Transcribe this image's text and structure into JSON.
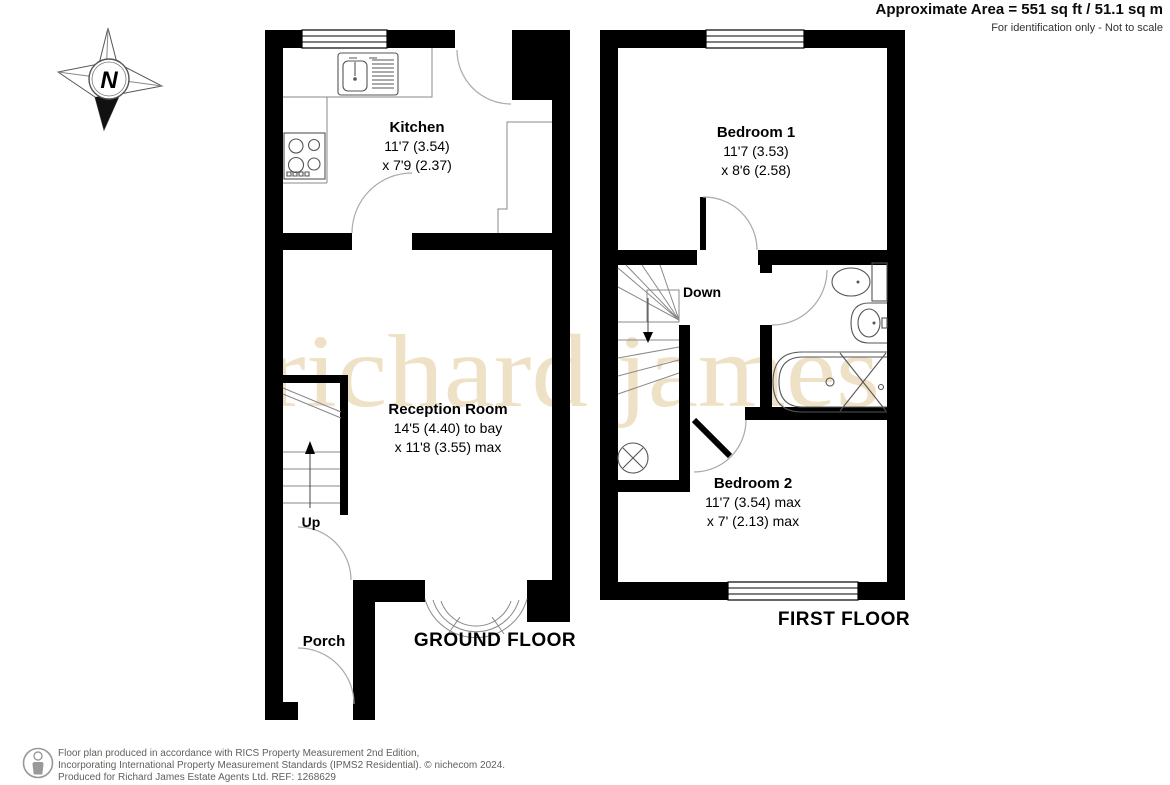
{
  "header": {
    "area_line": "Approximate Area = 551 sq ft / 51.1 sq m",
    "disclaimer": "For identification only - Not to scale"
  },
  "compass": {
    "north_label": "N"
  },
  "watermark": "richard james",
  "ground_floor": {
    "floor_label": "GROUND FLOOR",
    "stairs_label": "Up",
    "rooms": [
      {
        "name": "Kitchen",
        "dim1": "11'7 (3.54)",
        "dim2": "x 7'9 (2.37)"
      },
      {
        "name": "Reception Room",
        "dim1": "14'5 (4.40) to bay",
        "dim2": "x 11'8 (3.55) max"
      },
      {
        "name": "Porch"
      }
    ]
  },
  "first_floor": {
    "floor_label": "FIRST FLOOR",
    "stairs_label": "Down",
    "rooms": [
      {
        "name": "Bedroom 1",
        "dim1": "11'7 (3.53)",
        "dim2": "x 8'6 (2.58)"
      },
      {
        "name": "Bedroom 2",
        "dim1": "11'7 (3.54) max",
        "dim2": "x 7' (2.13) max"
      }
    ]
  },
  "footer": {
    "line1": "Floor plan produced in accordance with RICS Property Measurement 2nd Edition,",
    "line2": "Incorporating International Property Measurement Standards (IPMS2 Residential).  © nichecom 2024.",
    "line3": "Produced for Richard James Estate Agents Ltd.   REF: 1268629"
  },
  "colors": {
    "wall": "#000000",
    "watermark": "#efe1c6",
    "footer_text": "#5f5f5c"
  }
}
